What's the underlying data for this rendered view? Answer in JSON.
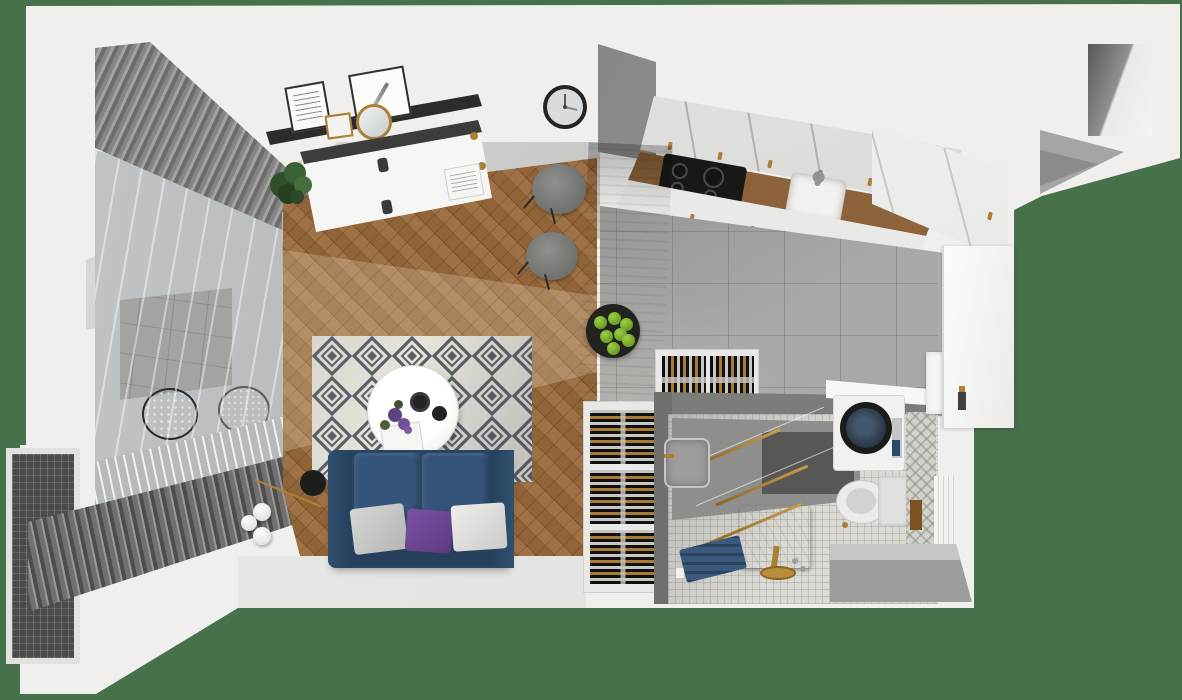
{
  "scene": {
    "kind": "3d-floorplan-render-top-down",
    "background_color": "#47714a",
    "wall_color": "#f0efed",
    "rooms": [
      {
        "name": "balcony",
        "features": [
          "glass sliding wall",
          "striped roller blinds",
          "gray tile floor",
          "dark rattan chair",
          "light rattan chair"
        ]
      },
      {
        "name": "living-room",
        "features": [
          "herringbone wood floor",
          "navy sofa",
          "diamond pattern rug",
          "round white coffee table",
          "globe floor lamp",
          "black wall shelf with art frames",
          "gold round mirror",
          "white sideboard with dark top",
          "potted plant",
          "wall clock"
        ]
      },
      {
        "name": "dining-area",
        "features": [
          "wood peninsula table",
          "two gray shell chairs",
          "black plate with green apples"
        ]
      },
      {
        "name": "kitchen",
        "features": [
          "white upper cabinets with gold handles",
          "wood countertop",
          "black cooktop with four burners",
          "white sink with faucet",
          "oven",
          "white lower cabinets",
          "tall white cabinet",
          "gray tile floor"
        ]
      },
      {
        "name": "bathroom",
        "features": [
          "white mosaic floor",
          "gray shower walls",
          "three gold towel bars",
          "gray wash basin",
          "white marble storage block",
          "gold floor faucet",
          "blue towel on rack",
          "washing machine with dark drum",
          "white laundry counter",
          "wall-hung toilet with tank",
          "herringbone accent wall strip",
          "white tile strip",
          "tiled bench",
          "white vanity with faucet"
        ]
      },
      {
        "name": "entry",
        "features": [
          "white entrance door with dark-and-gold handle",
          "gray corridor tiles"
        ]
      }
    ],
    "objects": {
      "wine_storage": "two white wine rack modules filled with horizontal bottles (gold and silver caps)",
      "sofa_pillow_colors": [
        "light gray",
        "purple",
        "white"
      ],
      "apple_count": 7,
      "wine_slots": 5
    },
    "palette": {
      "green_background": "#47714a",
      "wood_floor": "#9a6a3c",
      "kitchen_tile": "#a8a8a4",
      "sofa_navy": "#2a4564",
      "pillow_purple": "#6f4796",
      "rug_diamond": "#595d66",
      "gold_accent": "#ab8034",
      "mosaic_floor": "#dad9d3",
      "drum_blue": "#2c3e50",
      "blind_dark": "#4d4d4b"
    },
    "labels": {
      "stage": "apartment top-down 3D render",
      "sofa": "navy sofa",
      "rug": "diamond rug",
      "coffee_table": "round coffee table",
      "dining_table": "wood dining peninsula",
      "cooktop": "black cooktop",
      "sink": "kitchen sink",
      "washer": "washing machine",
      "toilet": "toilet",
      "door": "entrance door",
      "wine_rack": "wine rack",
      "clock": "wall clock",
      "balcony": "balcony with blinds"
    }
  }
}
